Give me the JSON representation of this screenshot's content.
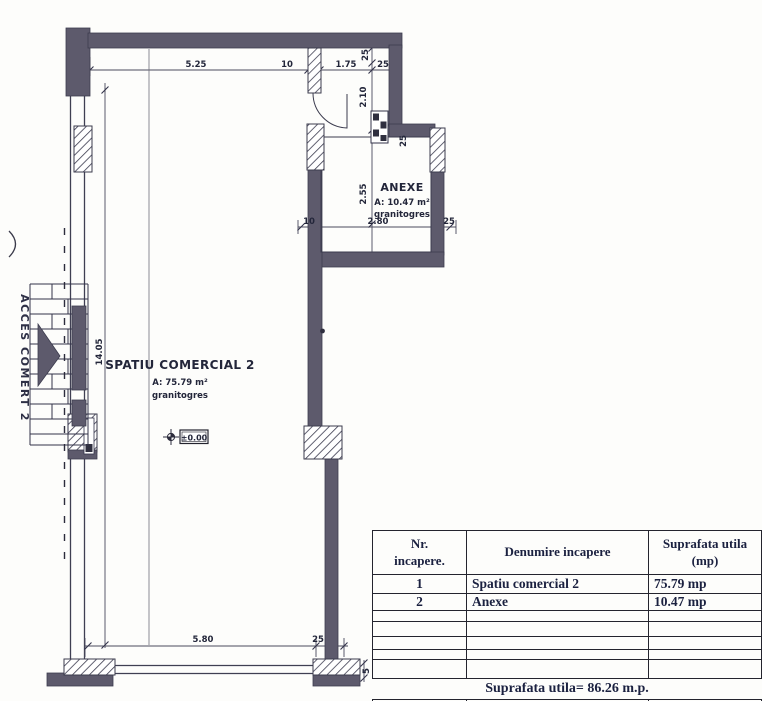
{
  "plan": {
    "access_label": "ACCES COMERT 2",
    "level_marker": "±0.00",
    "rooms": {
      "main": {
        "name": "SPATIU COMERCIAL 2",
        "area": "A: 75.79 m²",
        "finish": "granitogres"
      },
      "anexe": {
        "name": "ANEXE",
        "area": "A: 10.47 m²",
        "finish": "granitogres"
      }
    },
    "dims": {
      "top_1": "5.25",
      "top_2": "10",
      "top_3": "1.75",
      "top_4": "25",
      "right_1": "25",
      "right_2": "2.10",
      "right_3": "25",
      "right_4": "2.55",
      "anexe_1": "10",
      "anexe_2": "2.80",
      "anexe_3": "25",
      "left_1": "14.05",
      "bottom_1": "5.80",
      "bottom_2": "25",
      "bottom_3": "5"
    }
  },
  "table": {
    "header": {
      "col1_line1": "Nr.",
      "col1_line2": "incapere.",
      "col2": "Denumire incapere",
      "col3_line1": "Suprafata utila",
      "col3_line2": "(mp)"
    },
    "rows": [
      {
        "nr": "1",
        "name": "Spatiu comercial 2",
        "area": "75.79  mp"
      },
      {
        "nr": "2",
        "name": "Anexe",
        "area": "10.47  mp"
      }
    ],
    "footer": "Suprafata utila= 86.26 m.p."
  },
  "colors": {
    "wall": "#5d5a6c",
    "hatch_line": "#3d3d50",
    "dim_line": "#4a4a5c",
    "text": "#23263a",
    "paper": "#fdfdfb"
  }
}
